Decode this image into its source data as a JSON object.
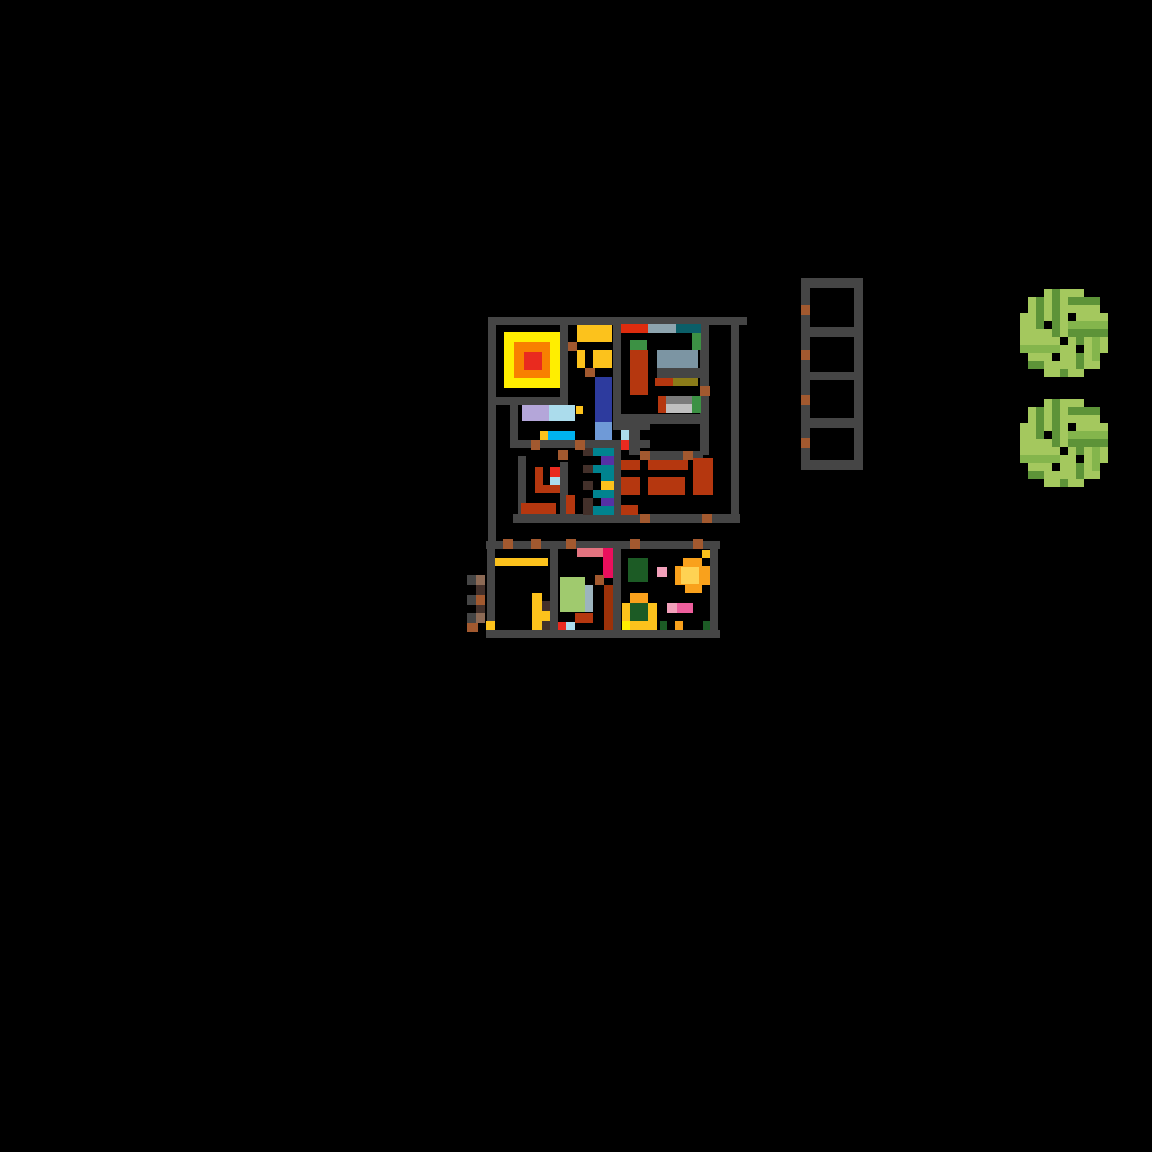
{
  "scene": {
    "width": 1152,
    "height": 1152,
    "background": "#000000"
  },
  "palette": {
    "W": "#454545",
    "S": "#a2592f",
    "b": "#43302a",
    "T": "#8d6a55",
    "R": "#b5370f",
    "E": "#e92a1f",
    "V": "#dd2c0e",
    "O": "#f88000",
    "Y": "#ffee00",
    "A": "#fcc21c",
    "l": "#b4a6d9",
    "c": "#abdcec",
    "s": "#00b2ef",
    "n": "#2d3b9e",
    "f": "#6f9ad7",
    "t": "#00838f",
    "d": "#0b5e68",
    "p": "#5531a5",
    "g": "#8da4ae",
    "G": "#7c95a3",
    "o": "#8b7c19",
    "e": "#3c9144",
    "D": "#1c5b25",
    "y": "#7b7b7b",
    "L": "#bfbfbf",
    "C": "#ea0f5d",
    "m": "#e2737f",
    "P": "#f2a0ba",
    "H": "#ee5f9d",
    "v": "#a0ca6e",
    "u": "#9cb4be",
    "r": "#9c3109",
    "F": "#f9a11c",
    "k": "#fed253"
  },
  "rects": [
    [
      488,
      317,
      259,
      8,
      "W",
      "wall-top"
    ],
    [
      488,
      325,
      8,
      216,
      "W",
      "wall-left"
    ],
    [
      487,
      541,
      8,
      97,
      "W",
      "wall-left-lower"
    ],
    [
      560,
      325,
      8,
      80,
      "W",
      "wall"
    ],
    [
      488,
      397,
      80,
      8,
      "W",
      "wall"
    ],
    [
      510,
      405,
      8,
      43,
      "W",
      "wall"
    ],
    [
      518,
      440,
      132,
      8,
      "W",
      "wall"
    ],
    [
      518,
      456,
      8,
      59,
      "W",
      "wall"
    ],
    [
      560,
      462,
      8,
      53,
      "W",
      "wall"
    ],
    [
      614,
      448,
      7,
      67,
      "W",
      "wall"
    ],
    [
      613,
      325,
      8,
      97,
      "W",
      "wall"
    ],
    [
      613,
      422,
      37,
      8,
      "W",
      "wall"
    ],
    [
      629,
      430,
      11,
      25,
      "W",
      "wall"
    ],
    [
      621,
      414,
      87,
      10,
      "W",
      "wall"
    ],
    [
      700,
      325,
      9,
      130,
      "W",
      "wall"
    ],
    [
      657,
      368,
      43,
      10,
      "W",
      "shelf-wall"
    ],
    [
      640,
      451,
      63,
      9,
      "W",
      "wall"
    ],
    [
      731,
      325,
      8,
      198,
      "W",
      "wall-right"
    ],
    [
      513,
      514,
      227,
      9,
      "W",
      "wall-bottom"
    ],
    [
      486,
      541,
      234,
      8,
      "W",
      "wall-annex-top"
    ],
    [
      486,
      630,
      234,
      8,
      "W",
      "wall-annex-bottom"
    ],
    [
      710,
      549,
      8,
      81,
      "W",
      "wall-annex-right"
    ],
    [
      550,
      549,
      8,
      81,
      "W",
      "wall"
    ],
    [
      613,
      549,
      8,
      81,
      "W",
      "wall"
    ],
    [
      467,
      575,
      9,
      10,
      "W",
      "ext-ladder-rung"
    ],
    [
      467,
      595,
      9,
      10,
      "W",
      "ext-ladder-rung"
    ],
    [
      467,
      613,
      9,
      10,
      "W",
      "ext-ladder-rung"
    ],
    [
      801,
      278,
      9,
      192,
      "W",
      "shelf-rail-left"
    ],
    [
      854,
      278,
      9,
      192,
      "W",
      "shelf-rail-right"
    ],
    [
      801,
      278,
      62,
      10,
      "W",
      "shelf-bar"
    ],
    [
      801,
      327,
      62,
      10,
      "W",
      "shelf-bar"
    ],
    [
      801,
      372,
      62,
      8,
      "W",
      "shelf-bar"
    ],
    [
      801,
      418,
      62,
      10,
      "W",
      "shelf-bar"
    ],
    [
      801,
      460,
      62,
      10,
      "W",
      "shelf-bar"
    ],
    [
      504,
      332,
      56,
      56,
      "Y",
      "rug-outer"
    ],
    [
      514,
      342,
      36,
      36,
      "O",
      "rug-middle"
    ],
    [
      524,
      352,
      18,
      18,
      "E",
      "rug-center"
    ],
    [
      577,
      325,
      35,
      17,
      "A",
      "table"
    ],
    [
      577,
      350,
      8,
      18,
      "A",
      "chair"
    ],
    [
      593,
      350,
      19,
      18,
      "A",
      "chair"
    ],
    [
      595,
      377,
      17,
      45,
      "n",
      "carpet"
    ],
    [
      595,
      422,
      17,
      18,
      "f",
      "carpet"
    ],
    [
      522,
      405,
      27,
      16,
      "l",
      "bed"
    ],
    [
      549,
      405,
      26,
      16,
      "c",
      "bed"
    ],
    [
      576,
      406,
      7,
      8,
      "A",
      "tile"
    ],
    [
      540,
      431,
      8,
      9,
      "A",
      "tile"
    ],
    [
      548,
      431,
      27,
      9,
      "s",
      "counter"
    ],
    [
      535,
      467,
      8,
      26,
      "R",
      "furniture"
    ],
    [
      535,
      485,
      25,
      8,
      "R",
      "furniture"
    ],
    [
      550,
      467,
      10,
      10,
      "E",
      "tile"
    ],
    [
      550,
      477,
      10,
      8,
      "c",
      "tile"
    ],
    [
      521,
      503,
      35,
      11,
      "R",
      "furniture"
    ],
    [
      566,
      495,
      9,
      19,
      "R",
      "furniture"
    ],
    [
      583,
      448,
      10,
      8,
      "b",
      "stair-step"
    ],
    [
      583,
      465,
      10,
      8,
      "b",
      "stair-step"
    ],
    [
      583,
      481,
      10,
      9,
      "b",
      "stair-step"
    ],
    [
      583,
      498,
      10,
      8,
      "b",
      "stair-step"
    ],
    [
      583,
      506,
      10,
      9,
      "b",
      "stair-step"
    ],
    [
      593,
      448,
      21,
      8,
      "t",
      "stair"
    ],
    [
      593,
      465,
      21,
      8,
      "t",
      "stair"
    ],
    [
      601,
      473,
      13,
      8,
      "t",
      "stair"
    ],
    [
      593,
      490,
      21,
      8,
      "t",
      "stair"
    ],
    [
      593,
      506,
      21,
      9,
      "t",
      "stair"
    ],
    [
      601,
      456,
      13,
      9,
      "p",
      "stair"
    ],
    [
      601,
      498,
      13,
      8,
      "p",
      "stair"
    ],
    [
      601,
      481,
      13,
      9,
      "A",
      "stair"
    ],
    [
      621,
      324,
      27,
      9,
      "V",
      "shelf-item"
    ],
    [
      648,
      324,
      28,
      9,
      "g",
      "shelf-item"
    ],
    [
      676,
      324,
      25,
      9,
      "d",
      "shelf-item"
    ],
    [
      692,
      333,
      9,
      17,
      "e",
      "shelf-item"
    ],
    [
      630,
      340,
      17,
      10,
      "e",
      "shelf-item"
    ],
    [
      630,
      350,
      18,
      45,
      "R",
      "bookcase"
    ],
    [
      657,
      350,
      41,
      18,
      "G",
      "shelf-item"
    ],
    [
      655,
      378,
      18,
      8,
      "R",
      "shelf-item"
    ],
    [
      673,
      378,
      25,
      8,
      "o",
      "shelf-item"
    ],
    [
      658,
      396,
      8,
      17,
      "R",
      "shelf-item"
    ],
    [
      666,
      396,
      26,
      8,
      "y",
      "shelf-item"
    ],
    [
      666,
      404,
      26,
      9,
      "L",
      "shelf-item"
    ],
    [
      692,
      396,
      9,
      17,
      "e",
      "shelf-item"
    ],
    [
      621,
      430,
      8,
      10,
      "c",
      "tile"
    ],
    [
      621,
      440,
      8,
      10,
      "E",
      "tile"
    ],
    [
      621,
      460,
      19,
      10,
      "R",
      "sofa"
    ],
    [
      648,
      460,
      40,
      10,
      "R",
      "sofa"
    ],
    [
      693,
      458,
      20,
      37,
      "R",
      "sofa"
    ],
    [
      621,
      477,
      19,
      18,
      "R",
      "sofa"
    ],
    [
      648,
      477,
      37,
      18,
      "R",
      "sofa"
    ],
    [
      621,
      505,
      17,
      10,
      "R",
      "sofa"
    ],
    [
      495,
      558,
      53,
      8,
      "A",
      "counter"
    ],
    [
      532,
      593,
      10,
      37,
      "A",
      "furniture"
    ],
    [
      542,
      601,
      8,
      10,
      "b",
      "furniture"
    ],
    [
      542,
      611,
      8,
      10,
      "A",
      "furniture"
    ],
    [
      542,
      621,
      8,
      9,
      "b",
      "furniture"
    ],
    [
      486,
      621,
      9,
      9,
      "A",
      "doorstep"
    ],
    [
      476,
      575,
      9,
      10,
      "T",
      "ext-ladder"
    ],
    [
      476,
      585,
      9,
      10,
      "b",
      "ext-ladder"
    ],
    [
      476,
      595,
      9,
      10,
      "S",
      "ext-ladder"
    ],
    [
      476,
      605,
      9,
      8,
      "b",
      "ext-ladder"
    ],
    [
      476,
      613,
      9,
      10,
      "T",
      "ext-ladder"
    ],
    [
      467,
      623,
      11,
      9,
      "S",
      "ext-ladder"
    ],
    [
      577,
      548,
      26,
      9,
      "m",
      "furniture"
    ],
    [
      603,
      548,
      10,
      30,
      "C",
      "furniture"
    ],
    [
      595,
      575,
      9,
      10,
      "S",
      "furniture"
    ],
    [
      604,
      585,
      9,
      45,
      "r",
      "furniture"
    ],
    [
      560,
      577,
      25,
      35,
      "v",
      "rug"
    ],
    [
      585,
      585,
      8,
      27,
      "u",
      "rug"
    ],
    [
      575,
      613,
      18,
      10,
      "R",
      "furniture"
    ],
    [
      558,
      622,
      8,
      8,
      "E",
      "tile"
    ],
    [
      566,
      622,
      9,
      8,
      "c",
      "tile"
    ],
    [
      628,
      558,
      20,
      24,
      "D",
      "plant-bed"
    ],
    [
      657,
      567,
      10,
      10,
      "P",
      "flower"
    ],
    [
      683,
      558,
      19,
      8,
      "F",
      "flower-glow"
    ],
    [
      675,
      566,
      35,
      19,
      "F",
      "flower-glow"
    ],
    [
      685,
      585,
      17,
      8,
      "F",
      "flower-glow"
    ],
    [
      681,
      567,
      18,
      17,
      "k",
      "flower-core"
    ],
    [
      702,
      550,
      8,
      8,
      "A",
      "tile"
    ],
    [
      630,
      593,
      18,
      10,
      "F",
      "planter"
    ],
    [
      622,
      603,
      8,
      18,
      "A",
      "planter"
    ],
    [
      648,
      603,
      9,
      18,
      "A",
      "planter"
    ],
    [
      630,
      603,
      18,
      18,
      "D",
      "planter-bush"
    ],
    [
      630,
      621,
      27,
      9,
      "A",
      "planter"
    ],
    [
      622,
      621,
      8,
      9,
      "Y",
      "planter"
    ],
    [
      667,
      603,
      10,
      10,
      "P",
      "flower"
    ],
    [
      677,
      603,
      16,
      10,
      "H",
      "flower"
    ],
    [
      660,
      621,
      7,
      9,
      "D",
      "tile"
    ],
    [
      675,
      621,
      8,
      9,
      "F",
      "tile"
    ],
    [
      703,
      621,
      7,
      9,
      "D",
      "tile"
    ],
    [
      568,
      342,
      9,
      9,
      "S",
      "door"
    ],
    [
      585,
      368,
      10,
      9,
      "S",
      "door"
    ],
    [
      531,
      440,
      9,
      10,
      "S",
      "door"
    ],
    [
      575,
      440,
      10,
      10,
      "S",
      "door"
    ],
    [
      558,
      450,
      10,
      10,
      "S",
      "door"
    ],
    [
      640,
      451,
      10,
      9,
      "S",
      "door"
    ],
    [
      683,
      451,
      10,
      9,
      "S",
      "door"
    ],
    [
      700,
      386,
      10,
      10,
      "S",
      "door"
    ],
    [
      640,
      514,
      10,
      9,
      "S",
      "door"
    ],
    [
      702,
      514,
      10,
      9,
      "S",
      "door"
    ],
    [
      503,
      539,
      10,
      10,
      "S",
      "door"
    ],
    [
      531,
      539,
      10,
      10,
      "S",
      "door"
    ],
    [
      566,
      539,
      10,
      10,
      "S",
      "door"
    ],
    [
      630,
      539,
      10,
      10,
      "S",
      "door"
    ],
    [
      693,
      539,
      10,
      10,
      "S",
      "door"
    ],
    [
      801,
      305,
      9,
      10,
      "S",
      "ladder-mark"
    ],
    [
      801,
      350,
      9,
      10,
      "S",
      "ladder-mark"
    ],
    [
      801,
      395,
      9,
      10,
      "S",
      "ladder-mark"
    ],
    [
      801,
      438,
      9,
      10,
      "S",
      "ladder-mark"
    ]
  ],
  "sprites": {
    "tree": {
      "cell": 8,
      "palette": {
        "L": "#a4c85e",
        "D": "#5d9338",
        "M": "#84b54c",
        "K": "#000000"
      },
      "rows": [
        "...LDLLL...",
        ".LDLDLDDDD.",
        ".LDLDLLLLL.",
        "LLDLDLKLLLL",
        "LLDKDLMMMMM",
        "LLLLDLDDDDD",
        "LLLLLKLDLML",
        "MMMMMLLKLML",
        ".LLLKLLDLM.",
        ".DDLLLLDLL.",
        "...LLDLL..."
      ]
    }
  },
  "sprite_instances": [
    {
      "sprite": "tree",
      "x": 1020,
      "y": 289,
      "name": "tree-top"
    },
    {
      "sprite": "tree",
      "x": 1020,
      "y": 399,
      "name": "tree-bottom"
    }
  ]
}
